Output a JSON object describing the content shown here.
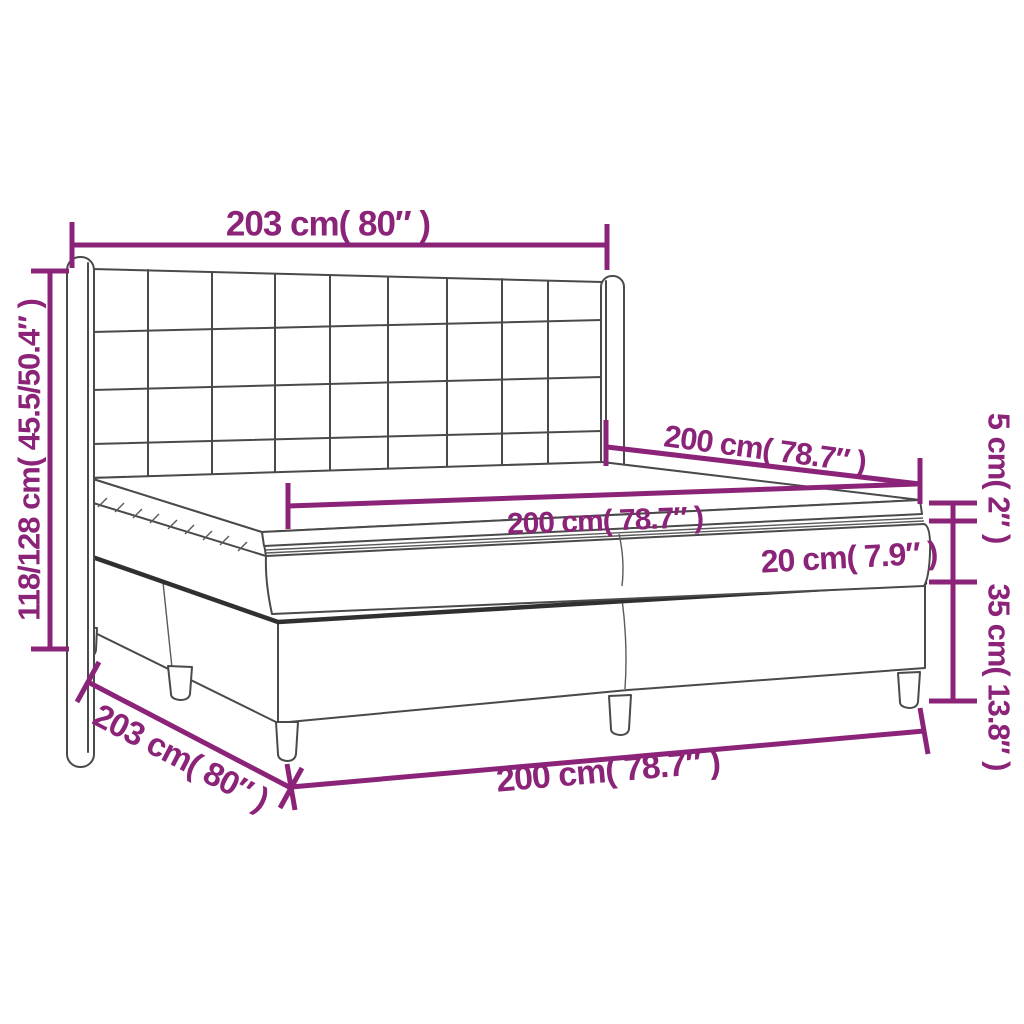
{
  "diagram": {
    "subject": "Box spring bed with tufted wing headboard, two-piece base, mattress and topper",
    "colors": {
      "accent": "#8B2478",
      "line_art": "#4A4A4A",
      "background": "#FFFFFF"
    },
    "dimensions": {
      "headboard_width": {
        "label": "203 cm( 80″ )",
        "value_cm": "203",
        "value_inch": "80"
      },
      "overall_height": {
        "label": "118/128 cm( 45.5/50.4″ )",
        "value_cm": "118/128",
        "value_inch": "45.5/50.4"
      },
      "mattress_depth": {
        "label": "200 cm( 78.7″ )",
        "value_cm": "200",
        "value_inch": "78.7"
      },
      "mattress_width": {
        "label": "200 cm( 78.7″ )",
        "value_cm": "200",
        "value_inch": "78.7"
      },
      "topper_thickness": {
        "label": "5 cm( 2″ )",
        "value_cm": "5",
        "value_inch": "2"
      },
      "mattress_thickness": {
        "label": "20 cm( 7.9″ )",
        "value_cm": "20",
        "value_inch": "7.9"
      },
      "base_height": {
        "label": "35 cm( 13.8″ )",
        "value_cm": "35",
        "value_inch": "13.8"
      },
      "base_depth": {
        "label": "203 cm( 80″ )",
        "value_cm": "203",
        "value_inch": "80"
      },
      "base_width": {
        "label": "200 cm( 78.7″ )",
        "value_cm": "200",
        "value_inch": "78.7"
      }
    }
  }
}
